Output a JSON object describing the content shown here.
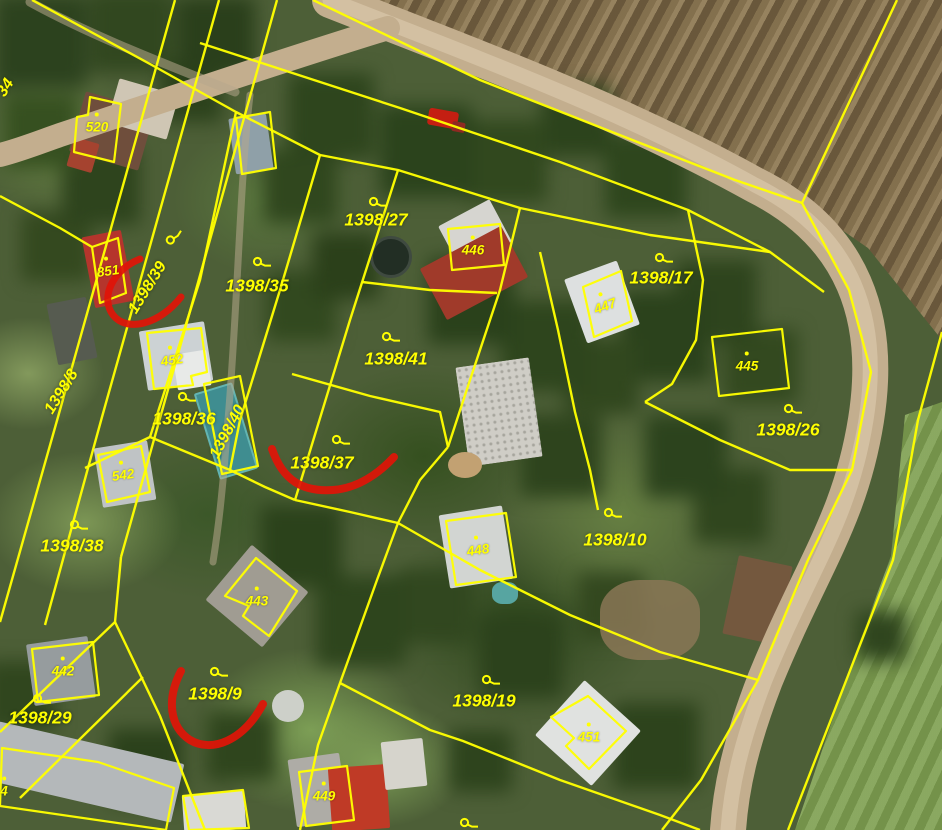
{
  "map": {
    "type": "cadastral-aerial-map",
    "colors": {
      "boundary": "#ffff00",
      "label": "#ffff00",
      "annotation": "#e01408",
      "road": "#c3ae8e"
    },
    "parcel_labels": [
      {
        "text": "1398/27",
        "x": 376,
        "y": 220,
        "rotation": 0
      },
      {
        "text": "1398/35",
        "x": 257,
        "y": 286,
        "rotation": 0
      },
      {
        "text": "1398/17",
        "x": 661,
        "y": 278,
        "rotation": 0
      },
      {
        "text": "1398/26",
        "x": 788,
        "y": 430,
        "rotation": 0
      },
      {
        "text": "1398/41",
        "x": 396,
        "y": 359,
        "rotation": 0
      },
      {
        "text": "1398/36",
        "x": 184,
        "y": 419,
        "rotation": 0
      },
      {
        "text": "1398/37",
        "x": 322,
        "y": 463,
        "rotation": 0
      },
      {
        "text": "1398/10",
        "x": 615,
        "y": 540,
        "rotation": 0
      },
      {
        "text": "1398/38",
        "x": 72,
        "y": 546,
        "rotation": 0
      },
      {
        "text": "1398/29",
        "x": 40,
        "y": 718,
        "rotation": 0
      },
      {
        "text": "1398/9",
        "x": 215,
        "y": 694,
        "rotation": 0
      },
      {
        "text": "1398/19",
        "x": 484,
        "y": 701,
        "rotation": 0
      },
      {
        "text": "1398/39",
        "x": 148,
        "y": 288,
        "rotation": -58
      },
      {
        "text": "1398/8",
        "x": 62,
        "y": 392,
        "rotation": -58
      },
      {
        "text": "1398/40",
        "x": 228,
        "y": 432,
        "rotation": -62
      },
      {
        "text": "34",
        "x": 6,
        "y": 88,
        "rotation": -58
      }
    ],
    "building_labels": [
      {
        "text": "520",
        "x": 97,
        "y": 127,
        "rotation": 0
      },
      {
        "text": "851",
        "x": 108,
        "y": 271,
        "rotation": -8
      },
      {
        "text": "452",
        "x": 172,
        "y": 360,
        "rotation": -8
      },
      {
        "text": "542",
        "x": 123,
        "y": 475,
        "rotation": -8
      },
      {
        "text": "446",
        "x": 473,
        "y": 250,
        "rotation": 0
      },
      {
        "text": "447",
        "x": 605,
        "y": 306,
        "rotation": -20
      },
      {
        "text": "445",
        "x": 747,
        "y": 366,
        "rotation": 0
      },
      {
        "text": "448",
        "x": 478,
        "y": 550,
        "rotation": -8
      },
      {
        "text": "443",
        "x": 257,
        "y": 601,
        "rotation": 0
      },
      {
        "text": "442",
        "x": 63,
        "y": 671,
        "rotation": 0
      },
      {
        "text": "451",
        "x": 589,
        "y": 737,
        "rotation": 0
      },
      {
        "text": "449",
        "x": 324,
        "y": 796,
        "rotation": 0
      },
      {
        "text": "4",
        "x": 4,
        "y": 791,
        "rotation": 0
      }
    ],
    "landuse_symbols": [
      {
        "x": 174,
        "y": 237,
        "rotation": -58
      },
      {
        "x": 262,
        "y": 263,
        "rotation": 0
      },
      {
        "x": 378,
        "y": 203,
        "rotation": 0
      },
      {
        "x": 664,
        "y": 259,
        "rotation": 0
      },
      {
        "x": 793,
        "y": 410,
        "rotation": 0
      },
      {
        "x": 391,
        "y": 338,
        "rotation": 0
      },
      {
        "x": 187,
        "y": 398,
        "rotation": 0
      },
      {
        "x": 341,
        "y": 441,
        "rotation": 0
      },
      {
        "x": 613,
        "y": 514,
        "rotation": 0
      },
      {
        "x": 79,
        "y": 526,
        "rotation": 0
      },
      {
        "x": 42,
        "y": 700,
        "rotation": 0
      },
      {
        "x": 219,
        "y": 673,
        "rotation": 0
      },
      {
        "x": 491,
        "y": 681,
        "rotation": 0
      },
      {
        "x": 469,
        "y": 824,
        "rotation": 0
      }
    ],
    "boundaries": [
      {
        "points": "313,0 480,80 640,143 735,180 802,203"
      },
      {
        "points": "897,0 802,203"
      },
      {
        "points": "200,43 400,108 560,162 688,210 770,252 824,292"
      },
      {
        "points": "802,203 849,290 871,372 852,470 808,560 758,680 701,780 662,830"
      },
      {
        "points": "942,332 918,420 893,560 851,668 788,830"
      },
      {
        "points": "32,0 150,64 236,112 320,155 398,170 520,208 650,235 770,252"
      },
      {
        "points": "175,0 58,417 0,622"
      },
      {
        "points": "219,0 102,417 45,625"
      },
      {
        "points": "277,0 225,186 180,347 121,557"
      },
      {
        "points": "121,557 115,622 0,732"
      },
      {
        "points": "115,622 160,716 205,830"
      },
      {
        "points": "143,677 20,798"
      },
      {
        "points": "236,112 200,280 150,437"
      },
      {
        "points": "320,155 280,290 240,420 230,470"
      },
      {
        "points": "398,170 350,320 295,500"
      },
      {
        "points": "85,468 150,437 230,470 265,487 295,500"
      },
      {
        "points": "292,374 370,396 440,412 448,447"
      },
      {
        "points": "295,500 350,512 398,523"
      },
      {
        "points": "448,447 420,480 398,523 377,580 340,683 318,745 300,830"
      },
      {
        "points": "398,523 480,570 570,615 660,652 758,680"
      },
      {
        "points": "340,683 430,730 463,741 560,780 660,815 700,830"
      },
      {
        "points": "520,208 500,290 470,380 448,447"
      },
      {
        "points": "362,282 430,290 497,293"
      },
      {
        "points": "688,210 703,280 696,340 672,384 645,402"
      },
      {
        "points": "540,252 558,330 575,412 590,470 598,510"
      },
      {
        "points": "645,402 720,440 790,470 852,470"
      },
      {
        "points": "0,196 60,228 92,247"
      }
    ],
    "building_outlines": [
      {
        "points": "77,117 88,115 90,97 121,104 114,162 74,152"
      },
      {
        "points": "92,247 118,238 126,293 100,303"
      },
      {
        "points": "147,333 201,328 207,372 191,376 193,385 154,389"
      },
      {
        "points": "98,455 141,446 150,492 107,502"
      },
      {
        "points": "448,229 500,224 504,265 452,270"
      },
      {
        "points": "583,287 621,271 632,321 594,337"
      },
      {
        "points": "712,337 782,329 789,388 719,396"
      },
      {
        "points": "446,521 506,513 516,577 456,585"
      },
      {
        "points": "256,558 297,591 269,636 243,616 249,606 225,596"
      },
      {
        "points": "32,649 93,642 99,695 38,702"
      },
      {
        "points": "588,696 626,731 589,769 566,746 574,738 551,717"
      },
      {
        "points": "299,772 347,766 354,820 306,826"
      },
      {
        "points": "2,748 98,762 174,788 166,830 0,806"
      },
      {
        "points": "183,796 243,790 249,828 189,830"
      },
      {
        "points": "236,118 270,112 276,168 242,174"
      },
      {
        "points": "204,384 240,376 258,466 222,474"
      }
    ],
    "red_annotations": [
      {
        "d": "M140,259 C112,270 100,298 113,315 C127,333 160,324 181,297",
        "width": 7
      },
      {
        "d": "M272,449 C283,481 303,492 333,490 C360,488 381,471 394,457",
        "width": 8
      },
      {
        "d": "M181,671 C166,700 170,727 190,740 C212,753 243,741 263,704",
        "width": 8
      }
    ]
  }
}
